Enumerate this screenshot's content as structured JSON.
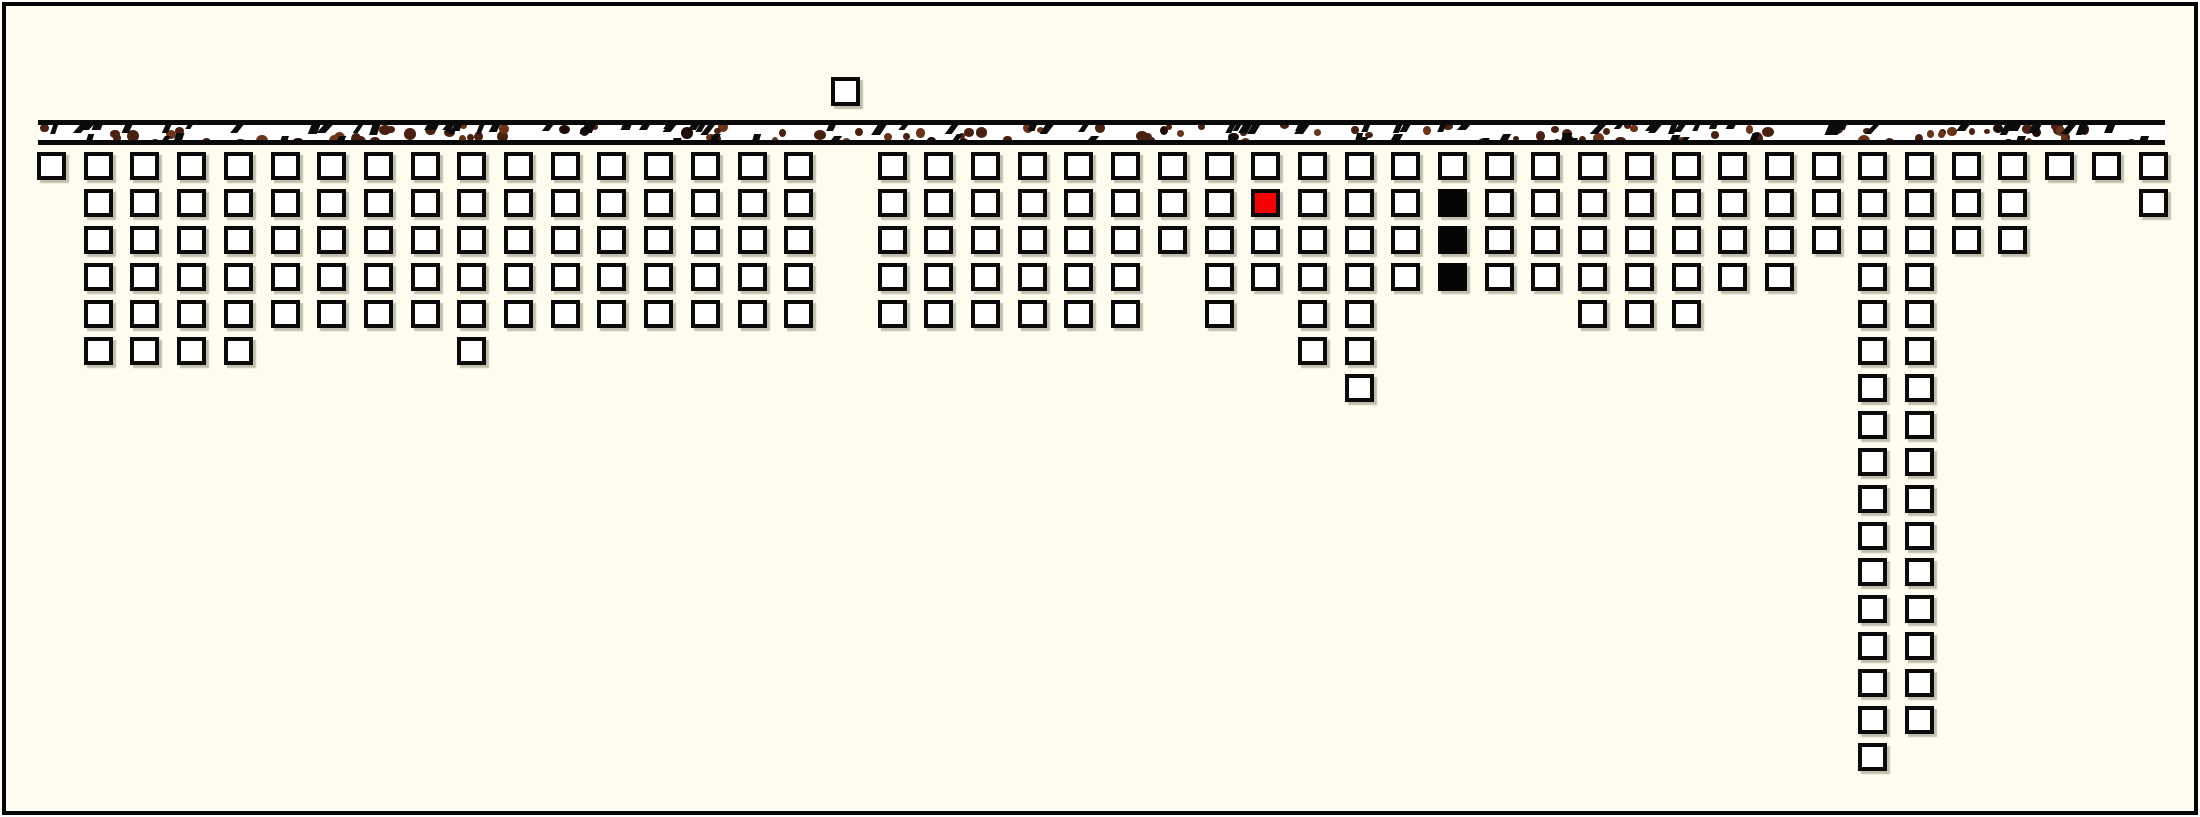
{
  "canvas": {
    "width": 2200,
    "height": 817,
    "outer_background": "#ffffff",
    "inner_background": "#fdfcee",
    "frame_color": "#050505",
    "frame_thickness": 4,
    "frame_inset": 2
  },
  "ground_strip": {
    "x": 38,
    "y": 120,
    "width": 2127,
    "height": 25,
    "edge_thickness": 5,
    "edge_color": "#0a0a0a",
    "fill": "#ffffff",
    "speckle_colors": {
      "brown": "#4a2110",
      "light_brown": "#6b3318",
      "near_black": "#1f0c04",
      "tick_black": "#0b0b0b"
    }
  },
  "grid": {
    "origin_x": 37,
    "row1_y": 152,
    "col_pitch": 46.7,
    "row_pitch": 36.95,
    "cell_width": 29,
    "cell_height": 28,
    "num_columns": 46
  },
  "cell_style": {
    "border_color": "#0a0a0a",
    "border_px": 4,
    "fill_default": "#ffffff",
    "fill_red": "#f70202",
    "fill_black": "#050505",
    "shadow_color": "rgba(120,115,95,0.45)"
  },
  "column_heights": [
    1,
    6,
    6,
    6,
    6,
    5,
    5,
    5,
    5,
    6,
    5,
    5,
    5,
    5,
    5,
    5,
    5,
    0,
    5,
    5,
    5,
    5,
    5,
    5,
    3,
    5,
    4,
    6,
    7,
    4,
    4,
    4,
    4,
    5,
    5,
    5,
    4,
    4,
    3,
    17,
    16,
    3,
    3,
    1,
    1,
    2
  ],
  "special_cells": [
    {
      "col": 27,
      "row": 2,
      "color": "red"
    },
    {
      "col": 31,
      "row": 2,
      "color": "black"
    },
    {
      "col": 31,
      "row": 3,
      "color": "black"
    },
    {
      "col": 31,
      "row": 4,
      "color": "black"
    }
  ],
  "floating_cell": {
    "col": 18,
    "y": 77,
    "width": 29,
    "height": 29
  }
}
